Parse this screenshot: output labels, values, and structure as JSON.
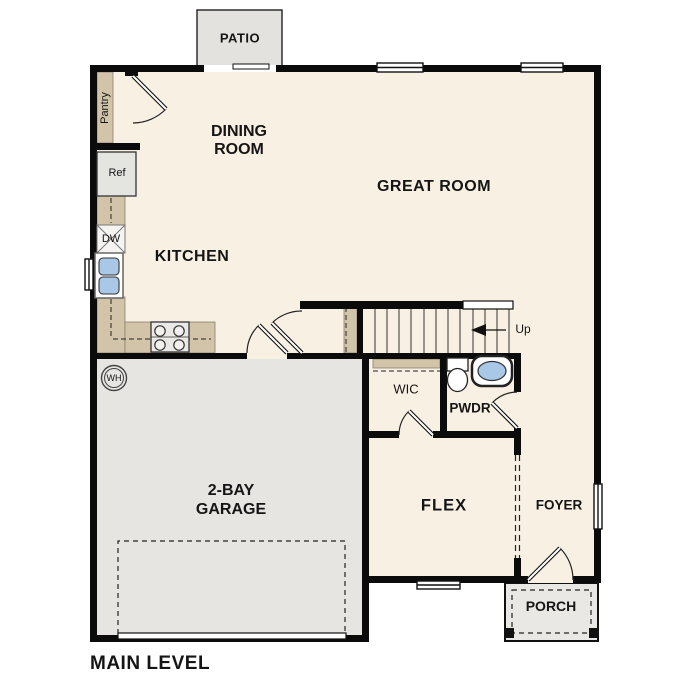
{
  "plan_title": "MAIN LEVEL",
  "labels": {
    "patio": "PATIO",
    "pantry": "Pantry",
    "dining_line1": "DINING",
    "dining_line2": "ROOM",
    "great_room": "GREAT ROOM",
    "ref": "Ref",
    "dw": "DW",
    "kitchen": "KITCHEN",
    "up": "Up",
    "wh": "WH",
    "wic": "WIC",
    "pwdr": "PWDR",
    "garage_line1": "2-BAY",
    "garage_line2": "GARAGE",
    "flex": "FLEX",
    "foyer": "FOYER",
    "porch": "PORCH"
  },
  "colors": {
    "floor": "#f8f0e3",
    "wall": "#0b0b0b",
    "counter_tan": "#d1c4a9",
    "garage_gray": "#e6e5e2",
    "patio_gray": "#e3e2df",
    "porch_gray": "#e9e8e5",
    "fixture_blue": "#a9c8e8"
  }
}
